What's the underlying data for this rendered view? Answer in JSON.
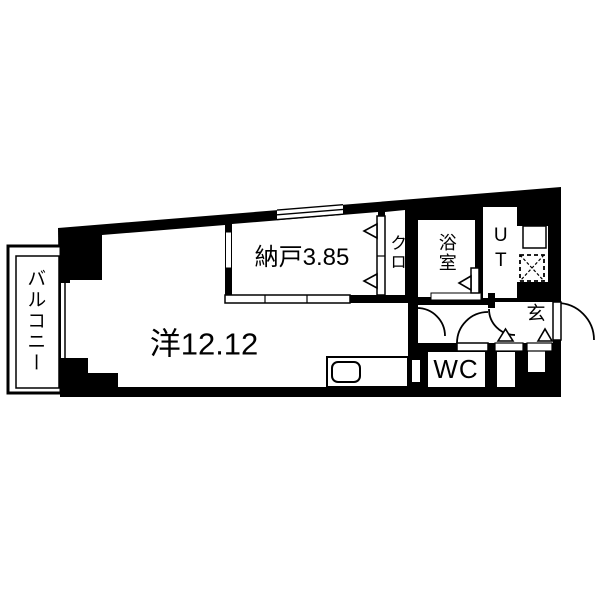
{
  "floorplan": {
    "colors": {
      "wall": "#000000",
      "floor": "#ffffff"
    },
    "rooms": [
      {
        "name": "balcony",
        "label": "バルコニー",
        "orientation": "vertical"
      },
      {
        "name": "western-room",
        "label": "洋12.12",
        "orientation": "horizontal"
      },
      {
        "name": "storage",
        "label": "納戸3.85",
        "orientation": "horizontal"
      },
      {
        "name": "closet",
        "label": "クロ",
        "orientation": "vertical"
      },
      {
        "name": "bathroom",
        "label": "浴室",
        "orientation": "vertical"
      },
      {
        "name": "utility",
        "label": "UT",
        "orientation": "vertical"
      },
      {
        "name": "entrance",
        "label": "玄",
        "orientation": "horizontal"
      },
      {
        "name": "toilet",
        "label": "WC",
        "orientation": "horizontal"
      }
    ],
    "symbols": {
      "washing_machine_icon": "dashed square with X",
      "door_swing_icon": "quarter-circle arc",
      "bifold_door_icon": "triangle arrow",
      "kitchen_sink_icon": "rounded rectangle in counter"
    }
  }
}
